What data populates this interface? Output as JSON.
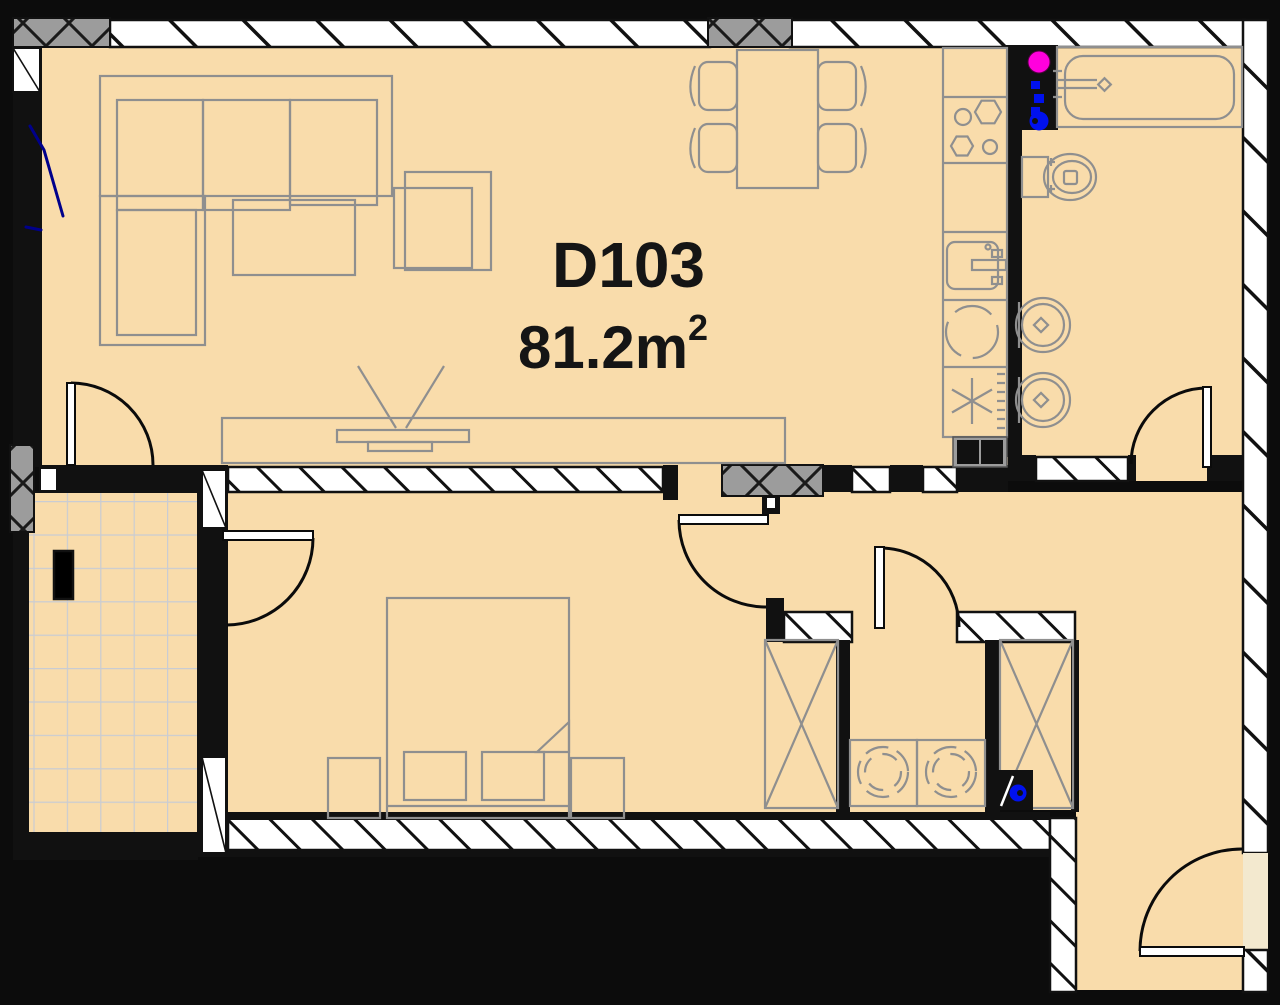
{
  "unit": {
    "id": "D103",
    "area_label": "81.2m",
    "area_sup": "2",
    "area_display": "81.2 m²"
  },
  "colors": {
    "floor": "#F9DCAB",
    "floor_light": "#F3E9CF",
    "wall_black": "#111111",
    "hatch_white": "#FFFFFF",
    "column_gray": "#9C9C9C",
    "furniture_gray": "#8F8F8F",
    "tile_line": "#C9CCD3",
    "riser_magenta": "#FF00DD",
    "fixture_blue": "#0011EE",
    "window_navy": "#00008B"
  },
  "fixtures": [
    "corner-sofa",
    "armchair",
    "coffee-table",
    "tv-unit",
    "dining-table",
    "dining-chair",
    "kitchen-counter",
    "cooktop",
    "kitchen-sink",
    "dishwasher",
    "refrigerator",
    "electric-panel",
    "bathtub",
    "toilet",
    "washbasin",
    "plumbing-riser",
    "wardrobe",
    "double-bed",
    "nightstand",
    "washing-machine",
    "water-heater",
    "balcony-tiles",
    "planter",
    "door-swing",
    "window"
  ]
}
